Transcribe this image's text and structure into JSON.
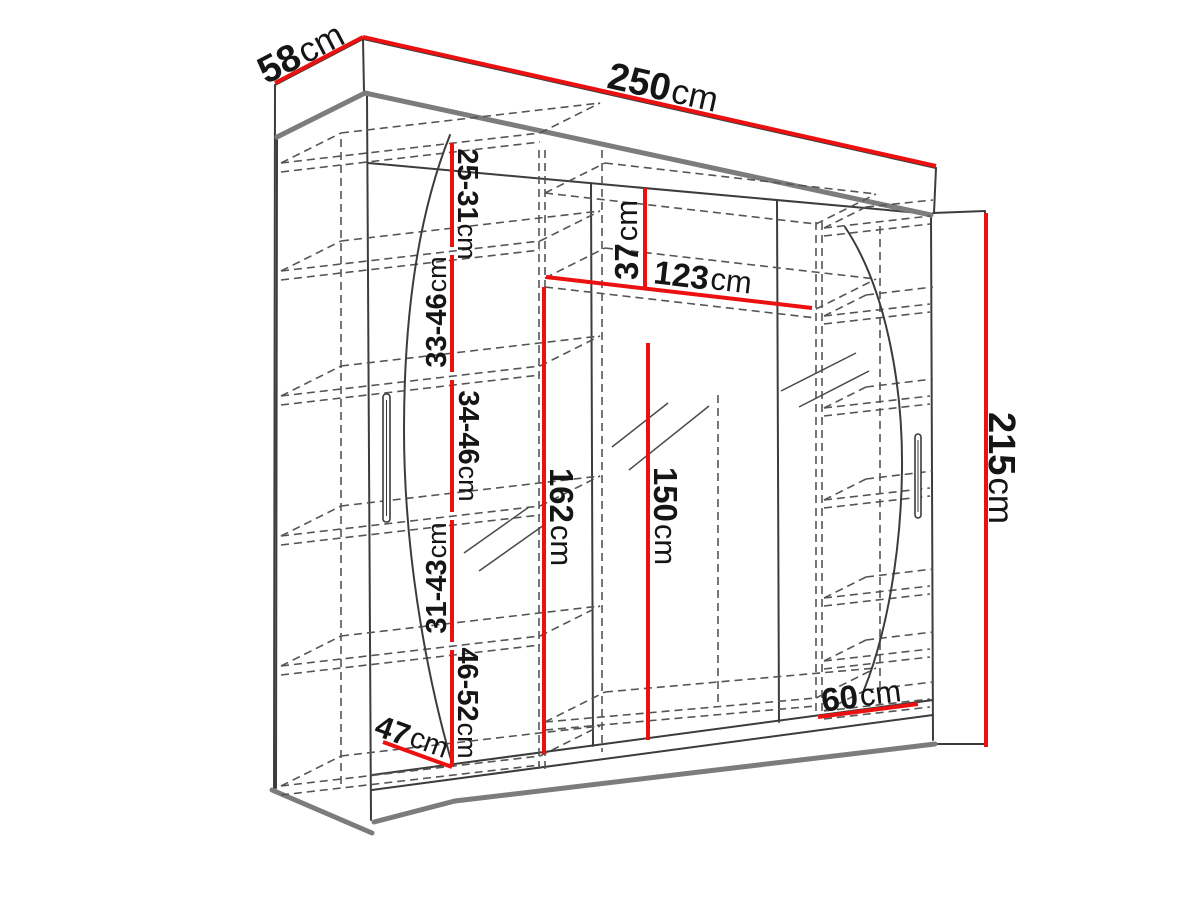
{
  "dimensions": [
    {
      "name": "depth",
      "value": "58",
      "unit": "cm"
    },
    {
      "name": "width",
      "value": "250",
      "unit": "cm"
    },
    {
      "name": "height",
      "value": "215",
      "unit": "cm"
    },
    {
      "name": "left-shelf-gap-1",
      "value": "25-31",
      "unit": "cm"
    },
    {
      "name": "left-shelf-gap-2",
      "value": "33-46",
      "unit": "cm"
    },
    {
      "name": "left-shelf-gap-3",
      "value": "34-46",
      "unit": "cm"
    },
    {
      "name": "left-shelf-gap-4",
      "value": "31-43",
      "unit": "cm"
    },
    {
      "name": "left-shelf-gap-5",
      "value": "46-52",
      "unit": "cm"
    },
    {
      "name": "top-clearance",
      "value": "37",
      "unit": "cm"
    },
    {
      "name": "middle-section-width",
      "value": "123",
      "unit": "cm"
    },
    {
      "name": "interior-height-left",
      "value": "162",
      "unit": "cm"
    },
    {
      "name": "interior-height-mid",
      "value": "150",
      "unit": "cm"
    },
    {
      "name": "right-section-width",
      "value": "60",
      "unit": "cm"
    },
    {
      "name": "left-section-width",
      "value": "47",
      "unit": "cm"
    }
  ],
  "colors": {
    "dimension_red": "#ec1111",
    "outline": "#3c3c3c",
    "thick_edge": "#7c7c7c",
    "dashed": "#555555",
    "label_text": "#151515",
    "background": "#ffffff"
  }
}
